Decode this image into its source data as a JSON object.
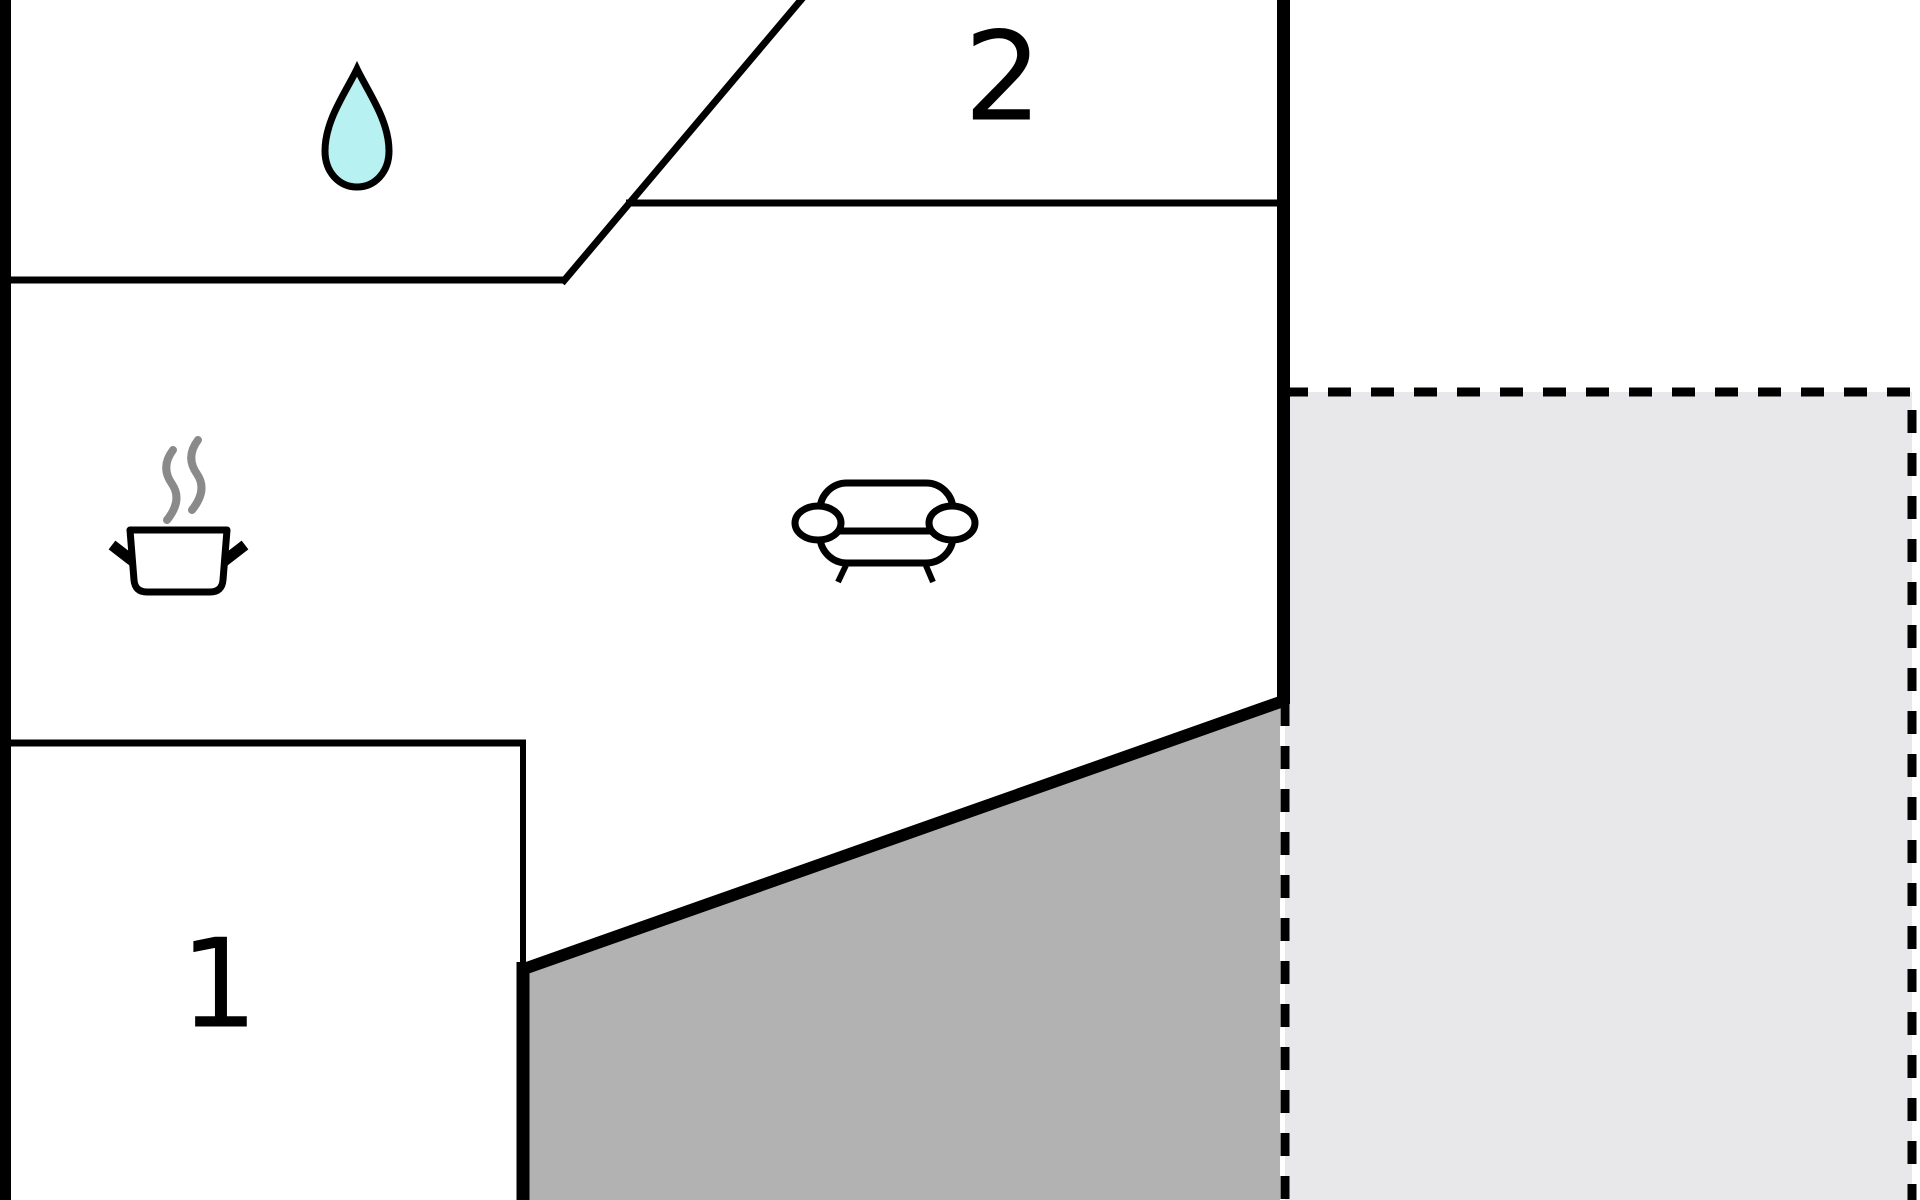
{
  "floorplan": {
    "title": "apartment-floor-plan",
    "rooms": {
      "room1": {
        "label": "1"
      },
      "room2": {
        "label": "2"
      }
    },
    "icons": {
      "water_drop": "water-drop (bathroom)",
      "cooking_pot": "cooking-pot-with-steam (kitchen)",
      "sofa": "sofa (living room)"
    },
    "colors": {
      "wall": "#000000",
      "background": "#ffffff",
      "droplet_fill": "#b8f1f1",
      "steam_stroke": "#8a8a8a",
      "terrace_fill": "#b2b2b2",
      "patio_fill": "#e8e8eb",
      "label_color": "#000000"
    }
  }
}
